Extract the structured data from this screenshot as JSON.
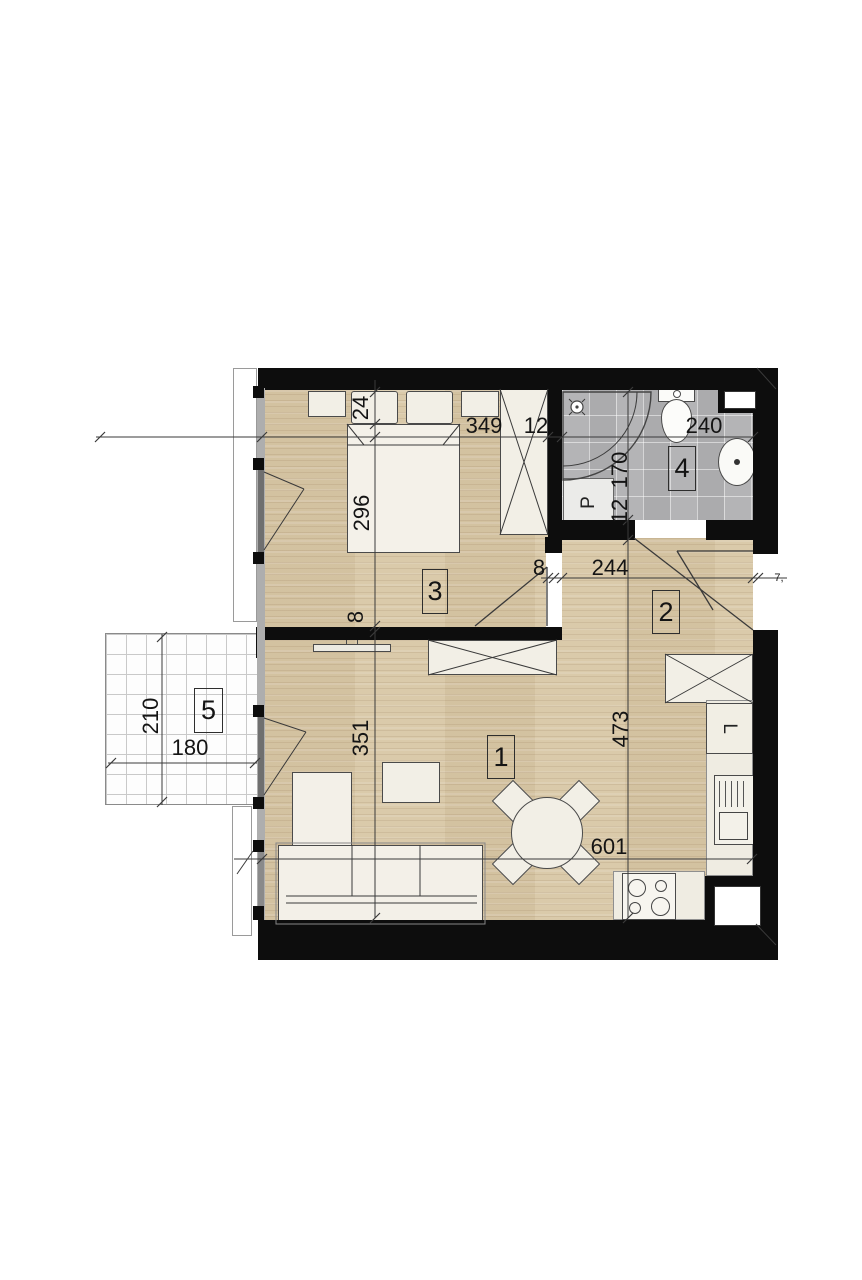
{
  "title": "apartment-floor-plan",
  "colors": {
    "wall": "#0d0d0d",
    "wood_floor": "#d8c7a6",
    "tile_floor": "#b4b4b6",
    "furniture": "#f2efe6",
    "balcony_grid": "#c9c9c9"
  },
  "rooms": {
    "living": {
      "number": "1"
    },
    "hall": {
      "number": "2"
    },
    "bedroom": {
      "number": "3"
    },
    "bathroom": {
      "number": "4"
    },
    "balcony": {
      "number": "5"
    }
  },
  "appliances": {
    "washing_machine": "P",
    "fridge": "L"
  },
  "dimensions": {
    "bed_recess": "24",
    "bedroom_width": "349",
    "wall_top": "12",
    "bathroom_width": "240",
    "bedroom_length": "296",
    "bathroom_length": "170",
    "bathroom_wall": "12",
    "hall_gap": "8",
    "hall_width": "244",
    "entry": "7,",
    "bedroom_wall_gap": "8",
    "living_length": "351",
    "kitchen_length": "473",
    "living_width": "601",
    "balcony_length": "210",
    "balcony_width": "180"
  }
}
